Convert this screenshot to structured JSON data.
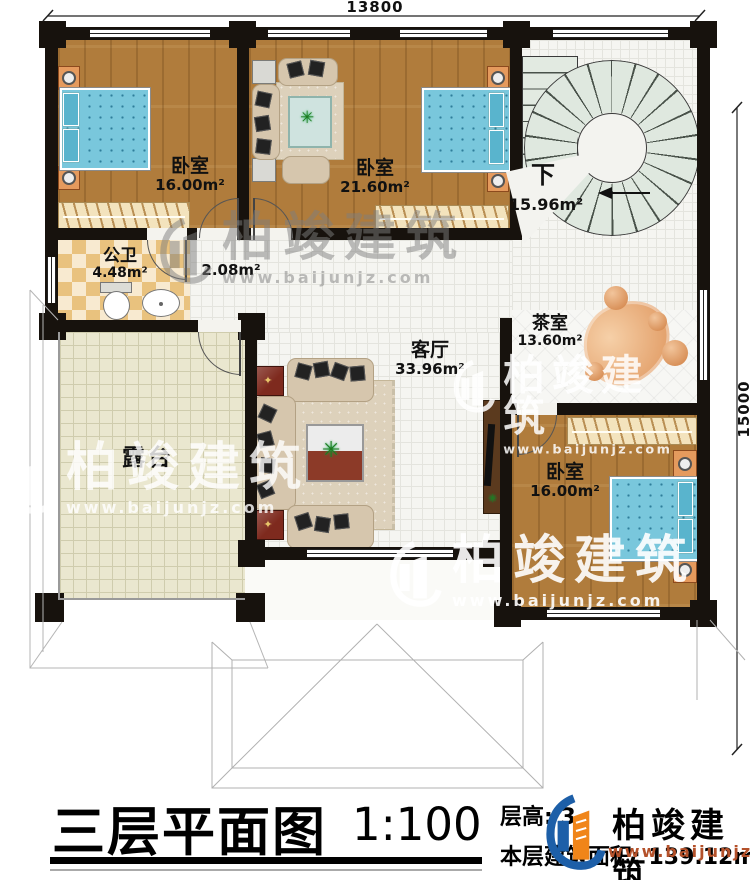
{
  "dimensions": {
    "width_label": "13800",
    "height_label": "15000"
  },
  "rooms": {
    "bedroom_nw": {
      "name": "卧室",
      "area": "16.00m²"
    },
    "bedroom_n": {
      "name": "卧室",
      "area": "21.60m²"
    },
    "stairwell": {
      "name": "下",
      "area": "15.96m²"
    },
    "bathroom": {
      "name": "公卫",
      "area": "4.48m²"
    },
    "hallway": {
      "area": "2.08m²"
    },
    "living_room": {
      "name": "客厅",
      "area": "33.96m²"
    },
    "tea_room": {
      "name": "茶室",
      "area": "13.60m²"
    },
    "bedroom_se": {
      "name": "卧室",
      "area": "16.00m²"
    },
    "terrace": {
      "name": "露台"
    }
  },
  "title_block": {
    "title": "三层平面图",
    "scale": "1:100",
    "floor_height_label": "层高: 3.",
    "floor_area_label": "本层建筑面积: 139.12m²"
  },
  "brand": {
    "name": "柏竣建筑",
    "website": "www.baijunjz.com"
  },
  "colors": {
    "wall": "#17120d",
    "wood_floor": "#b07c3c",
    "bed_blue": "#79c7dc",
    "brand_blue": "#1d5fa8",
    "brand_orange": "#f08519",
    "site_orange": "#b4512a"
  }
}
